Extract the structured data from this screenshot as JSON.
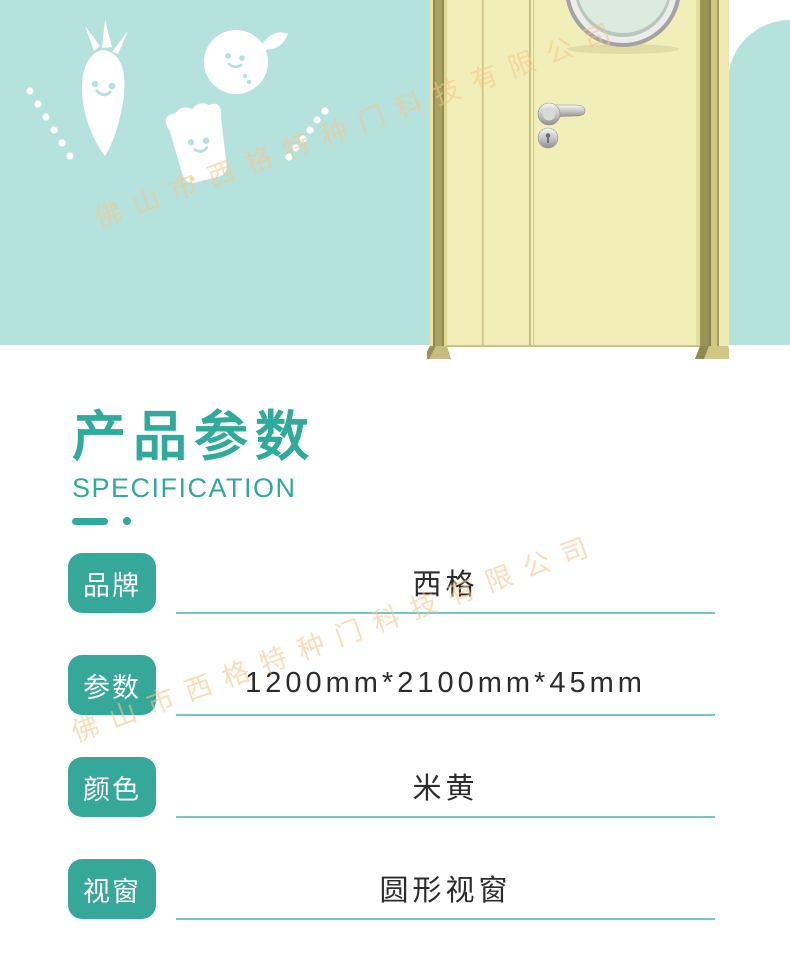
{
  "watermark": {
    "text": "佛山市西格特种门科技有限公司"
  },
  "banner": {
    "illustrations": [
      "carrot-icon",
      "orange-icon",
      "bread-icon",
      "dots-decoration"
    ],
    "door": {
      "description_icons": [
        "door-illustration",
        "porthole-window-icon",
        "door-handle-icon",
        "keyhole-icon"
      ]
    }
  },
  "section": {
    "title_cn": "产品参数",
    "title_en": "SPECIFICATION"
  },
  "spec_table": {
    "rows": [
      {
        "label": "品牌",
        "value": "西格"
      },
      {
        "label": "参数",
        "value": "1200mm*2100mm*45mm"
      },
      {
        "label": "颜色",
        "value": "米黄"
      },
      {
        "label": "视窗",
        "value": "圆形视窗"
      }
    ]
  },
  "colors": {
    "banner_teal": "#b6e2de",
    "accent_teal": "#2faa9b",
    "badge_teal": "#35a89a",
    "underline_teal": "#74c9c0",
    "door_yellow": "#f2eeba",
    "watermark_orange": "rgba(245,198,138,0.58)"
  }
}
